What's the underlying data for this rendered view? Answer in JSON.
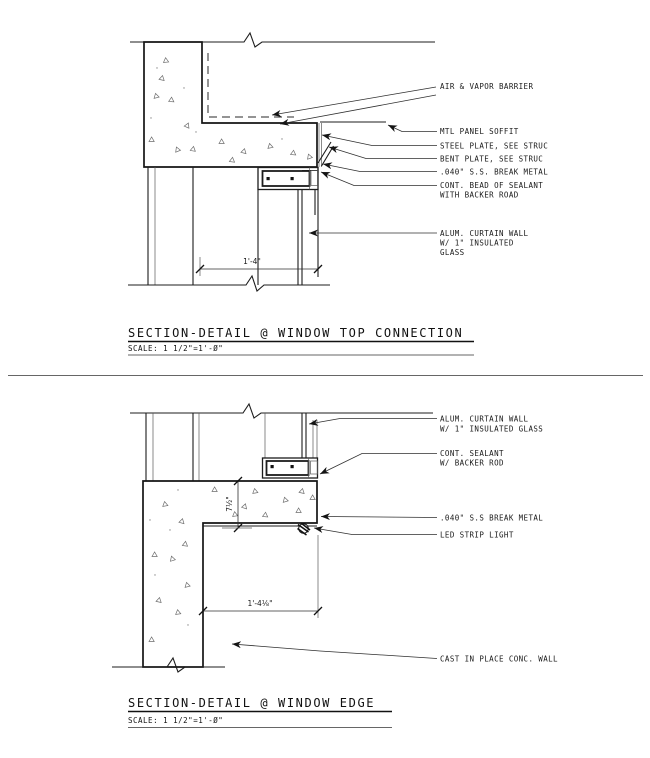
{
  "sheet": {
    "background": "#ffffff",
    "line_color": "#1a1a1a"
  },
  "top_detail": {
    "title": "SECTION-DETAIL @ WINDOW TOP CONNECTION",
    "scale": "SCALE: 1 1/2\"=1'-Ø\"",
    "width_dim": "1'-4\"",
    "labels": {
      "air_vapor": "AIR & VAPOR BARRIER",
      "soffit": "MTL PANEL SOFFIT",
      "steel_plate": "STEEL PLATE, SEE STRUC",
      "bent_plate": "BENT PLATE, SEE STRUC",
      "break_metal": ".040\" S.S. BREAK METAL",
      "sealant_line1": "CONT. BEAD OF SEALANT",
      "sealant_line2": "WITH BACKER ROAD",
      "curtain_line1": "ALUM. CURTAIN WALL",
      "curtain_line2": "W/ 1\" INSULATED",
      "curtain_line3": "GLASS"
    }
  },
  "bottom_detail": {
    "title": "SECTION-DETAIL @ WINDOW EDGE",
    "scale": "SCALE: 1 1/2\"=1'-Ø\"",
    "width_dim": "1'-4⅛\"",
    "height_dim": "7½\"",
    "labels": {
      "curtain_line1": "ALUM. CURTAIN WALL",
      "curtain_line2": "W/ 1\" INSULATED GLASS",
      "sealant_line1": "CONT. SEALANT",
      "sealant_line2": "W/ BACKER ROD",
      "break_metal": ".040\" S.S BREAK METAL",
      "led": "LED STRIP LIGHT",
      "conc_wall": "CAST IN PLACE CONC. WALL"
    }
  }
}
